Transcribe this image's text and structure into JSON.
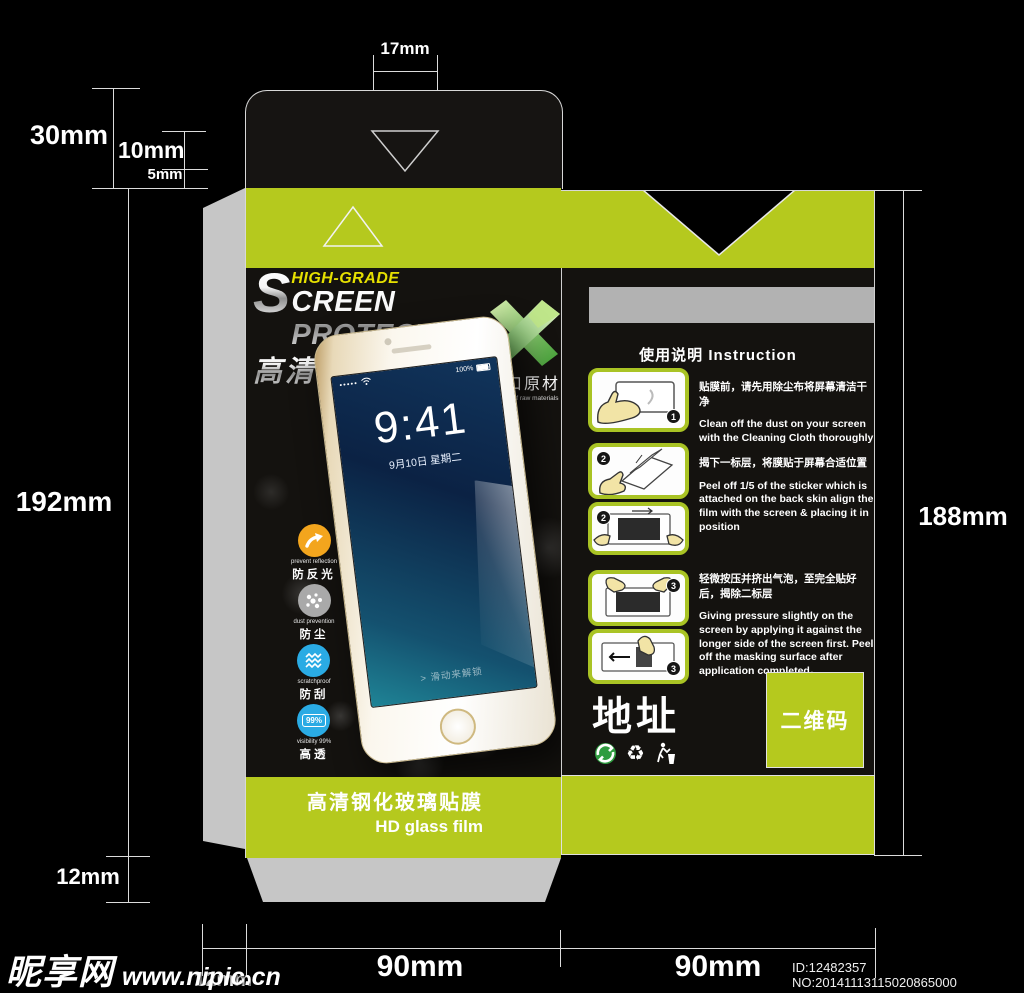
{
  "colors": {
    "lime": "#b5c91e",
    "panel_black": "#14120f",
    "gray_flap": "#c6c6c6",
    "gray_bar": "#b2b2b2",
    "tagline_yellow": "#e6e000",
    "x_green": "#4ba53c",
    "icon_orange": "#f3a51d",
    "icon_gray": "#a9a9a9",
    "icon_blue": "#2aabe4"
  },
  "dims": {
    "tab_width": "17mm",
    "flap_total": "30mm",
    "flap_mid": "10mm",
    "flap_small": "5mm",
    "front_height": "192mm",
    "back_height": "188mm",
    "bottom_flap": "12mm",
    "glue_strip": "12mm",
    "front_width": "90mm",
    "back_width": "90mm"
  },
  "front_panel": {
    "tagline": "HIGH-GRADE",
    "title_initial": "S",
    "title_rest": "CREEN PROTECTOR",
    "title_cn": "高清保护膜",
    "import_badge_cn": "进口原材",
    "import_badge_en": "imports of raw materials",
    "phone": {
      "signal_dots": "●●●●●",
      "battery": "100%",
      "time": "9:41",
      "date": "9月10日 星期二",
      "unlock_hint": "> 滑动来解锁"
    },
    "features": [
      {
        "en": "prevent reflection",
        "cn": "防反光"
      },
      {
        "en": "dust prevention",
        "cn": "防尘"
      },
      {
        "en": "scratchproof",
        "cn": "防刮"
      },
      {
        "en": "visibility 99%",
        "cn": "高透",
        "badge": "99%"
      }
    ]
  },
  "back_panel": {
    "instruction_title": "使用说明 Instruction",
    "steps": [
      {
        "num": "1",
        "cn": "贴膜前，请先用除尘布将屏幕清洁干净",
        "en": "Clean off the dust on your screen with the Cleaning Cloth thoroughly"
      },
      {
        "num": "2",
        "cn": "揭下一标层，将膜贴于屏幕合适位置",
        "en": "Peel off 1/5 of the sticker which is attached on the back skin align the film with the screen & placing it in position"
      },
      {
        "num": "3",
        "cn": "轻微按压并挤出气泡，至完全贴好后，揭除二标层",
        "en": "Giving pressure slightly on the screen by applying it against the longer side of the screen first. Peel off the masking surface after application completed。"
      }
    ],
    "address_label": "地址",
    "qr_label": "二维码"
  },
  "bottom_bar": {
    "cn": "高清钢化玻璃贴膜",
    "en": "HD glass film"
  },
  "footer": {
    "site_name": "昵享网",
    "site_url": "www.nipic.cn",
    "id_text": "ID:12482357 NO:20141113115020865000"
  }
}
